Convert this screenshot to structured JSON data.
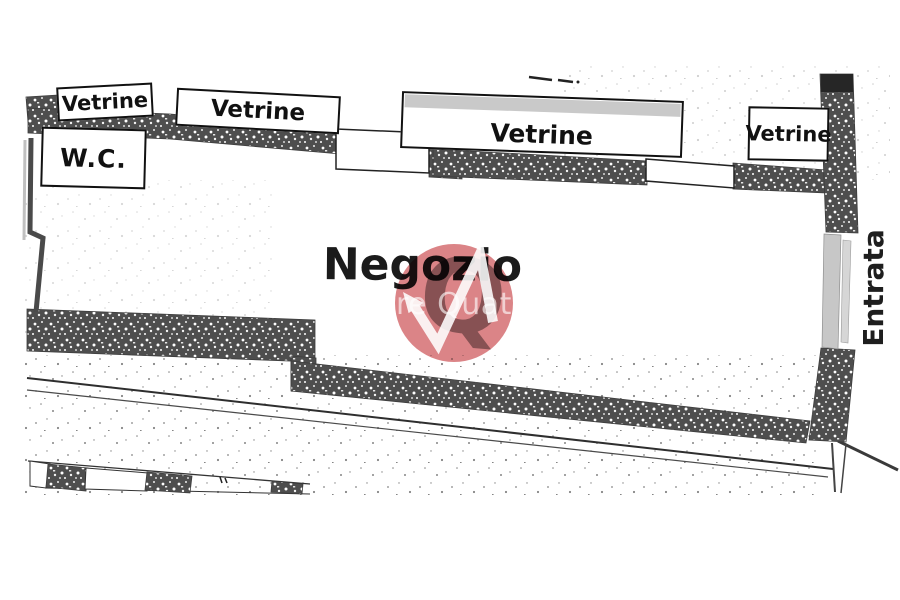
{
  "plan": {
    "vetrine_labels": [
      "Vetrine",
      "Vetrine",
      "Vetrine",
      "Vetrine"
    ],
    "wc_label": "W.C.",
    "room_label": "Negozio",
    "entrance_label": "Entrata"
  },
  "watermark": {
    "visible_text": "re Quat",
    "monogram_letter": "Q",
    "circle_color": "#c5383c",
    "monogram_color": "#6e6e6e"
  },
  "colors": {
    "paper": "#ffffff",
    "wall": "#4e4e4e",
    "line": "#2e2e2e",
    "door": "#c7c7c7",
    "label_text": "#141414"
  }
}
